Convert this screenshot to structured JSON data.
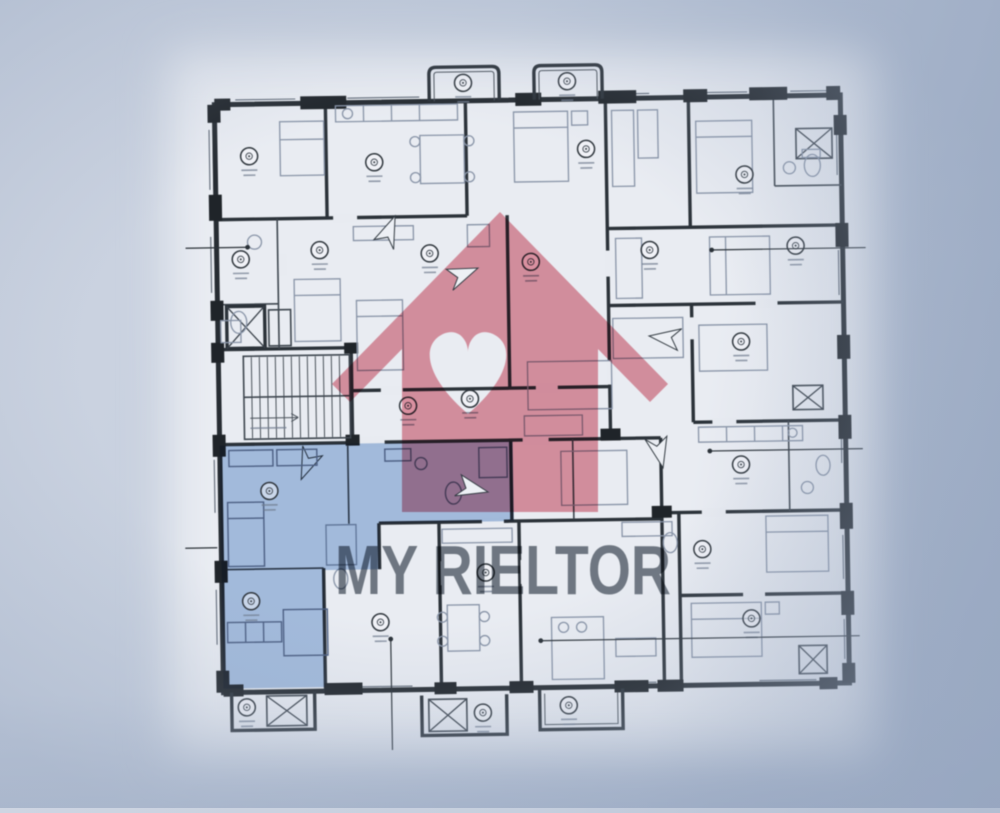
{
  "image": {
    "kind": "apartment-floor-plan-photo",
    "watermark": {
      "brand_text": "MY RIELTOR",
      "logo": "house-with-heart-icon",
      "logo_color": "#dd5168",
      "text_color": "#515b68"
    },
    "highlighted_apartment": {
      "fill": "#6597d6",
      "position": "lower-left"
    },
    "palette": {
      "photo_background": "#b4bfd2",
      "paper": "#e9ecf2",
      "walls": "#262c33",
      "furniture_lines": "#8794a9"
    }
  }
}
